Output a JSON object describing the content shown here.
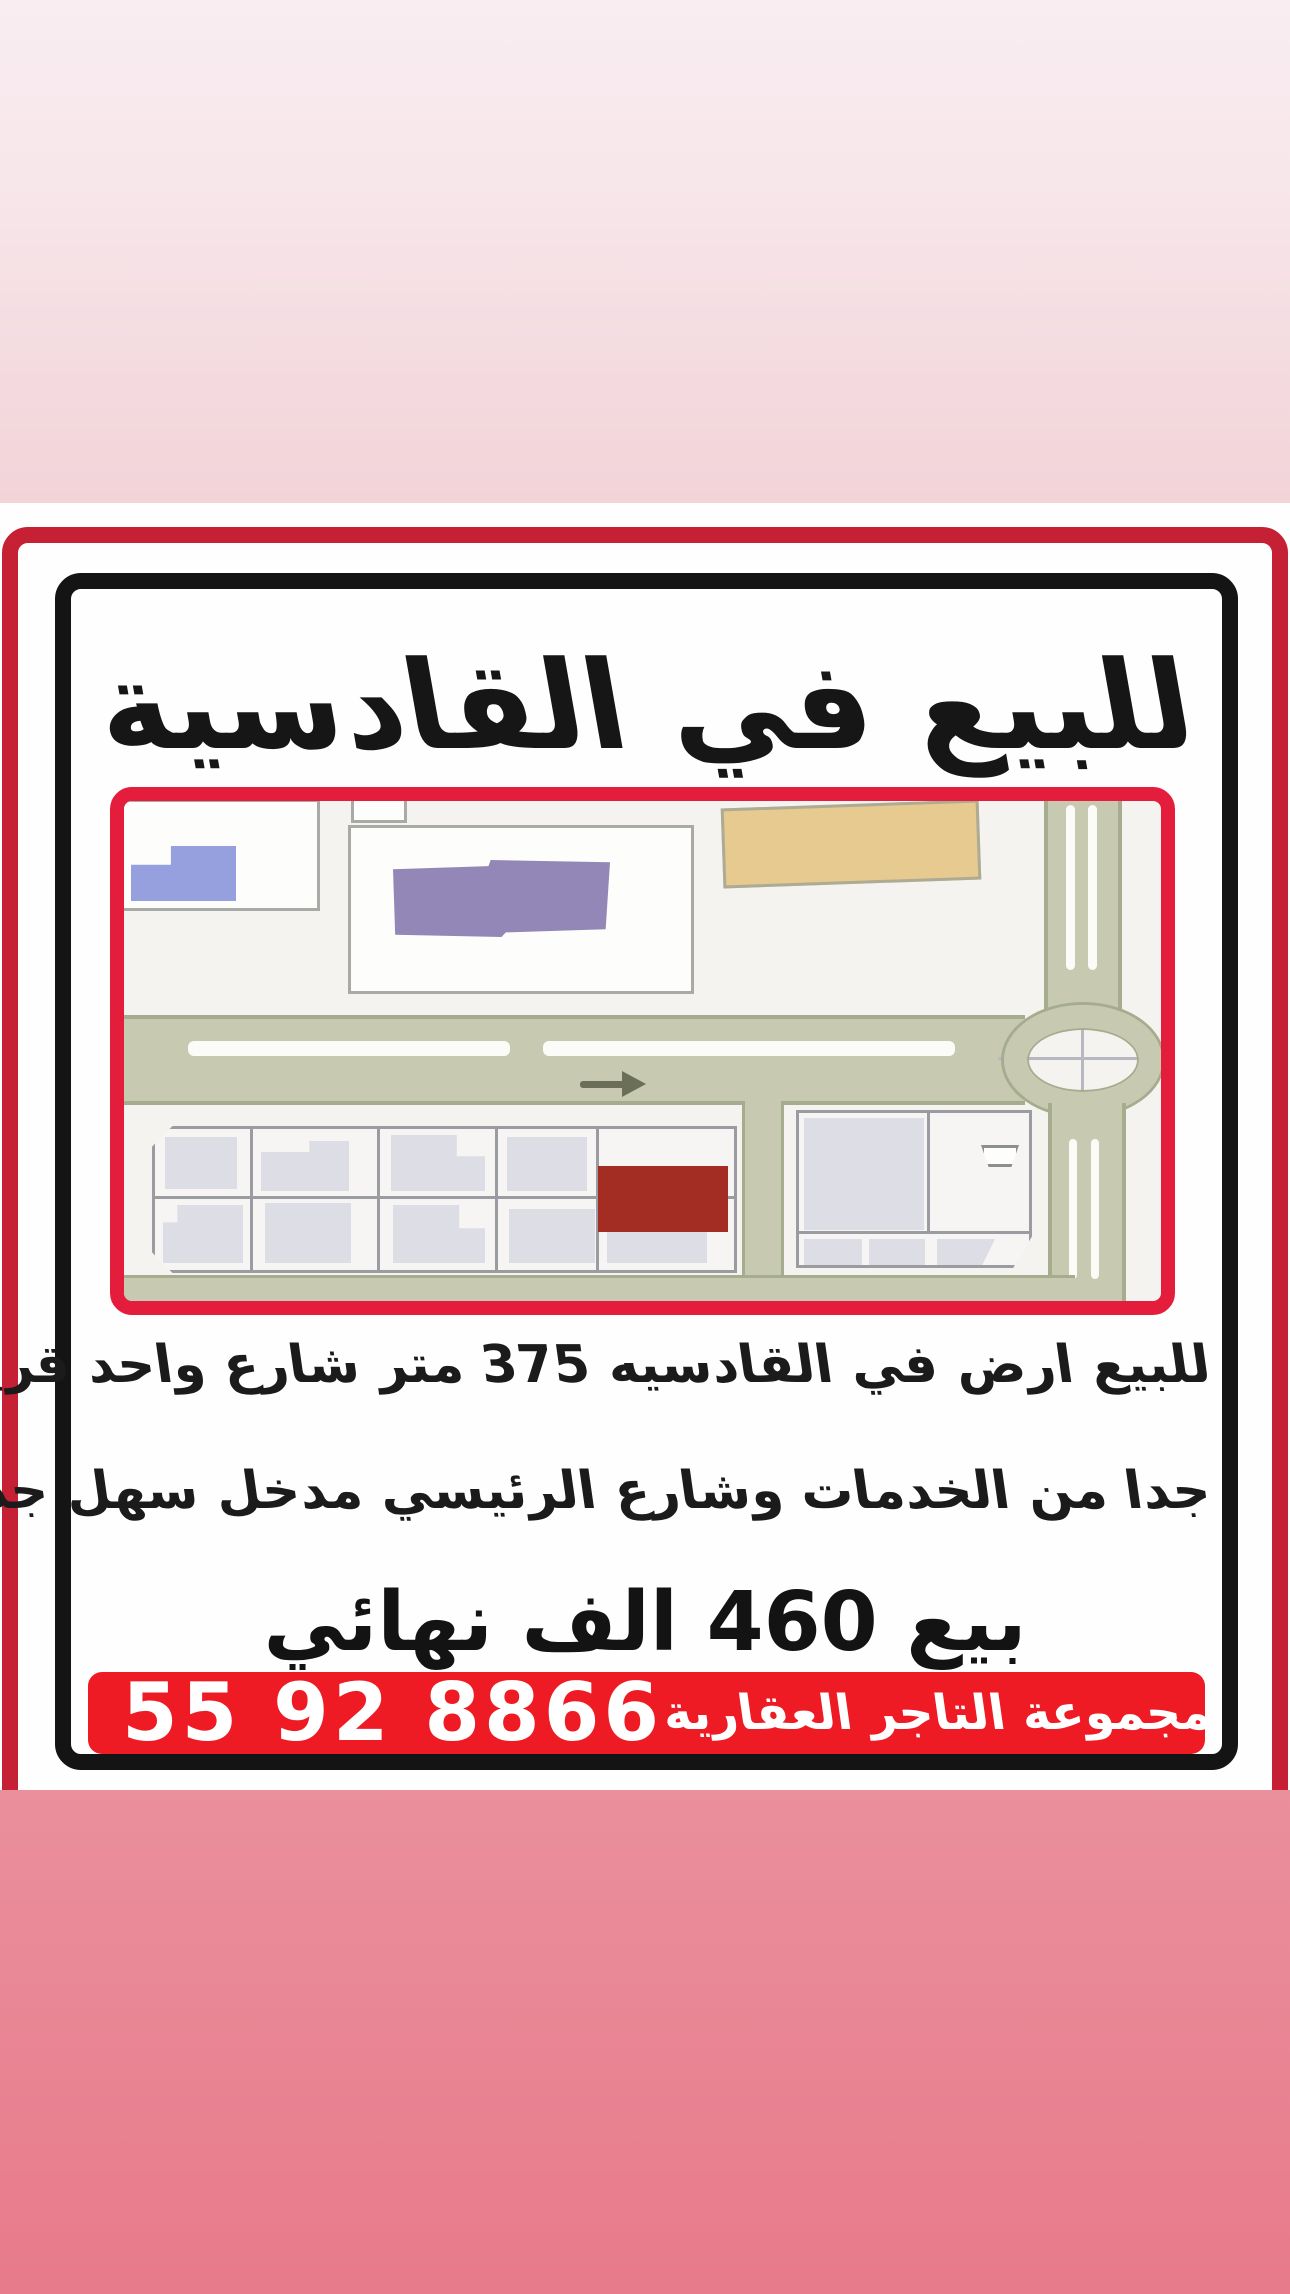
{
  "page": {
    "background_top_color": "#f9edf1",
    "background_bottom_color": "#e77a8b"
  },
  "poster": {
    "title": "للبيع في القادسية",
    "description_line1": "للبيع ارض في القادسيه 375 متر  شارع واحد قريب",
    "description_line2": "جدا من الخدمات وشارع الرئيسي مدخل سهل جدا",
    "price_line": "بيع 460 الف نهائي",
    "footer": {
      "phone": "55 92 8866",
      "company": "مجموعة التاجر العقارية",
      "bar_color": "#ee1b24"
    },
    "colors": {
      "outer_border": "#c52033",
      "inner_frame": "#141414",
      "map_border": "#e51d3d"
    }
  },
  "map": {
    "type": "area-location-map",
    "highlighted_plot_color": "#a42d23",
    "road_color": "#c7cab1",
    "background_color": "#f4f3f0",
    "building_colors": {
      "blue": "#96a0df",
      "purple": "#9287b6",
      "tan": "#e6ca90",
      "gray": "#dcdde5"
    },
    "features": [
      "roundabout-right",
      "horizontal-main-road-with-arrow",
      "vertical-road",
      "parcel-grid-bottom",
      "highlighted-plot"
    ]
  }
}
